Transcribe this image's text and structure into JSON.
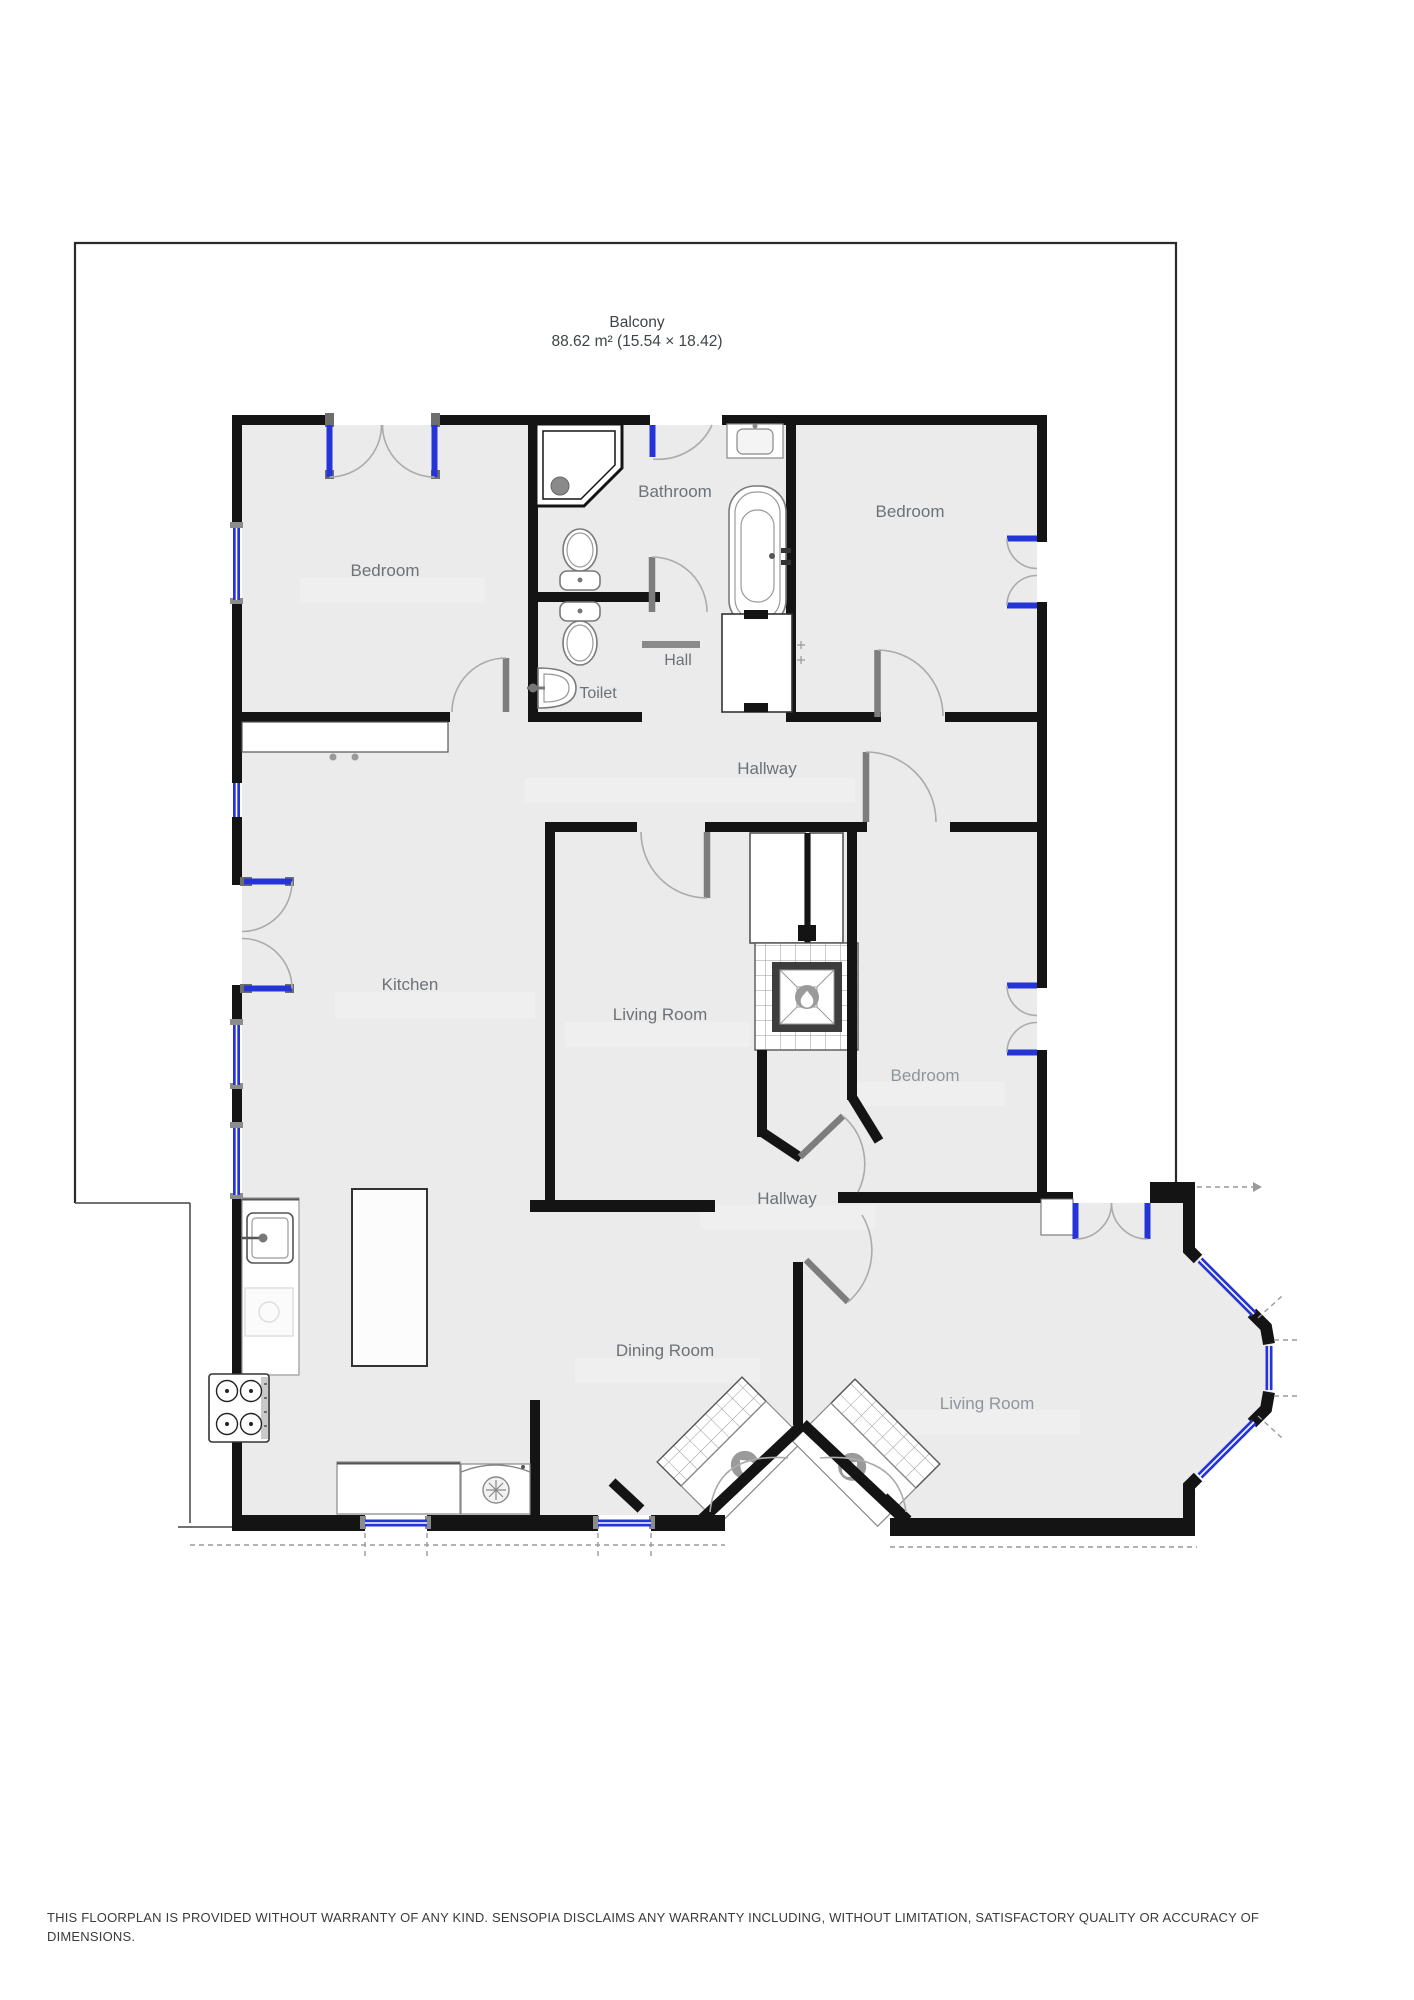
{
  "balcony": {
    "label": "Balcony",
    "area": "88.62 m² (15.54 × 18.42)"
  },
  "rooms": {
    "bedroom_tl": "Bedroom",
    "bathroom": "Bathroom",
    "bedroom_tr": "Bedroom",
    "hall": "Hall",
    "toilet": "Toilet",
    "hallway_upper": "Hallway",
    "kitchen": "Kitchen",
    "living_room_mid": "Living Room",
    "bedroom_mid": "Bedroom",
    "hallway_lower": "Hallway",
    "dining_room": "Dining Room",
    "living_room_br": "Living Room"
  },
  "fixtures": [
    "corner-shower",
    "toilet-bathroom",
    "toilet-wc",
    "corner-sink",
    "bathtub",
    "vanity-sink",
    "hall-closet",
    "wardrobe",
    "fireplace-center",
    "chimney-flues",
    "kitchen-sink",
    "kitchen-counter",
    "dishwasher",
    "stove-4-burners",
    "kitchen-island",
    "worktop",
    "washing-machine",
    "corner-fireplace-left",
    "corner-fireplace-right"
  ],
  "disclaimer": {
    "line1": "THIS FLOORPLAN IS PROVIDED WITHOUT WARRANTY OF ANY KIND. SENSOPIA DISCLAIMS ANY WARRANTY INCLUDING, WITHOUT LIMITATION, SATISFACTORY QUALITY OR ACCURACY OF",
    "line2": "DIMENSIONS."
  },
  "colors": {
    "wall": "#141414",
    "window_blue": "#2434d9",
    "door_arc": "#ababab",
    "door_leaf": "#7d7d7d",
    "label_text": "#6d7277",
    "room_fill": "#ebebeb",
    "outline": "#222222"
  }
}
